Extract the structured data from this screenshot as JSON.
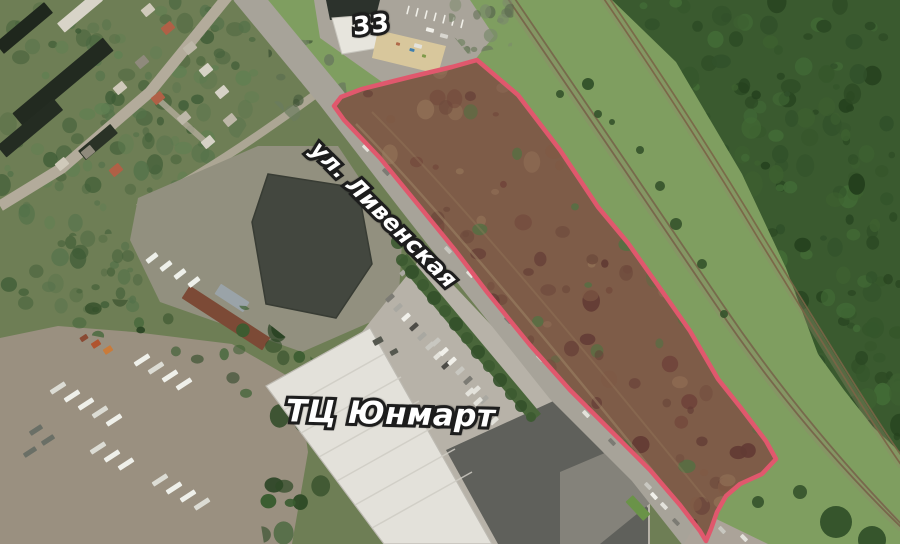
{
  "map": {
    "labels": {
      "building_number": "33",
      "street_name": "ул. Ливенская",
      "mall_name": "ТЦ Юнмарт"
    },
    "parcel": {
      "outline_color": "#e0586d",
      "points": "477,60 452,67 410,77 362,89 341,97 334,106 344,120 380,158 420,207 455,250 487,292 530,345 570,390 610,430 650,470 680,505 700,531 706,541 711,529 717,512 726,496 740,484 762,474 776,459 766,441 741,408 718,379 690,331 662,291 628,243 598,207 560,150 518,95"
    }
  }
}
